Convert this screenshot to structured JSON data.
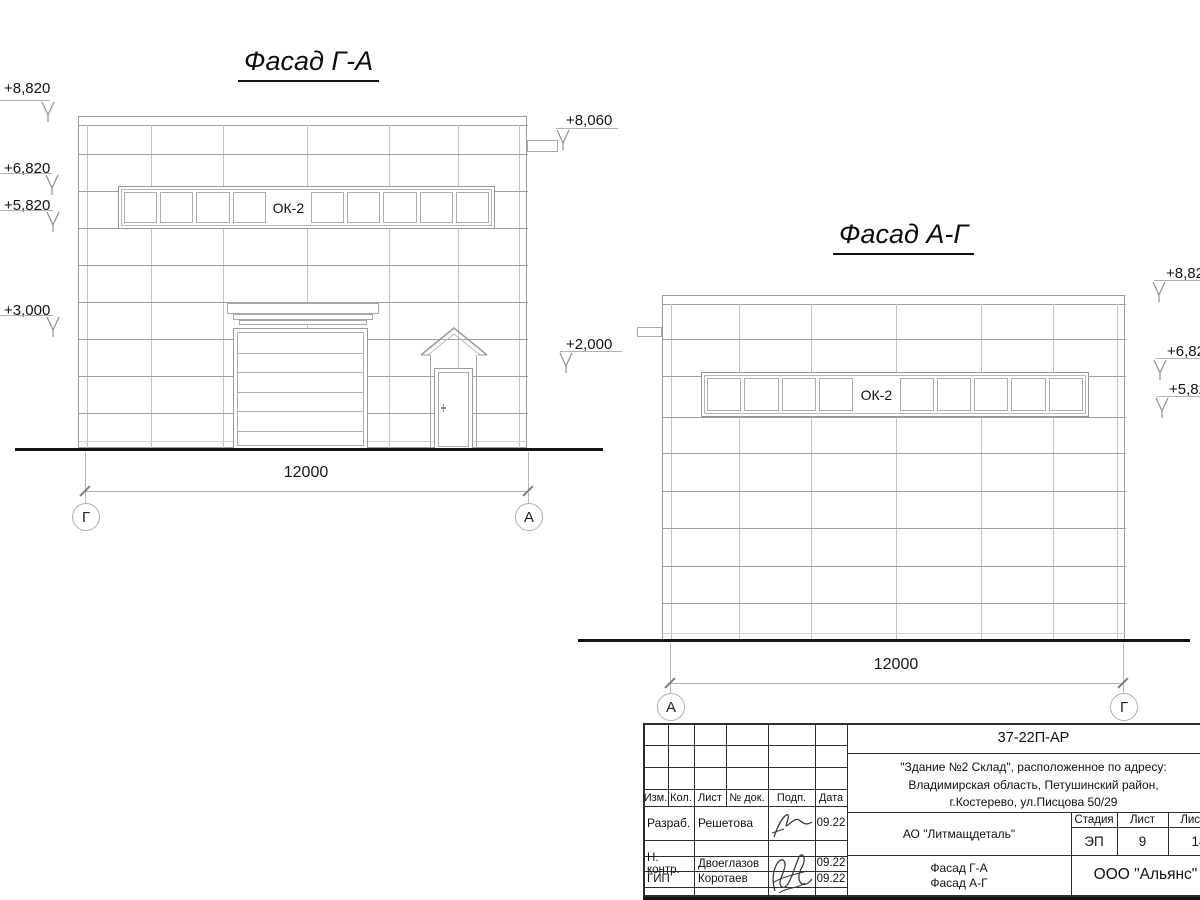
{
  "facade_ga": {
    "title": "Фасад Г-А",
    "window_label": "ОК-2",
    "dimension": "12000",
    "axis_left": "Г",
    "axis_right": "А",
    "elev_8820": "+8,820",
    "elev_6820": "+6,820",
    "elev_5820": "+5,820",
    "elev_3000": "+3,000",
    "elev_8060": "+8,060",
    "elev_2000": "+2,000"
  },
  "facade_ag": {
    "title": "Фасад А-Г",
    "window_label": "ОК-2",
    "dimension": "12000",
    "axis_left": "А",
    "axis_right": "Г",
    "elev_882": "+8,82",
    "elev_682": "+6,82",
    "elev_582": "+5,82"
  },
  "titleblock": {
    "doc_number": "37-22П-АР",
    "project_line1": "\"Здание №2 Склад\", расположенное по адресу:",
    "project_line2": "Владимирская область, Петушинский район,",
    "project_line3": "г.Костерево, ул.Писцова 50/29",
    "col_izm": "Изм.",
    "col_kol": "Кол.",
    "col_list": "Лист",
    "col_doc": "№ док.",
    "col_podp": "Подп.",
    "col_data": "Дата",
    "row1_role": "Разраб.",
    "row1_name": "Решетова",
    "row1_date": "09.22",
    "row2_role": "Н. контр.",
    "row2_name": "Двоеглазов",
    "row2_date": "09.22",
    "row3_role": "ГИП",
    "row3_name": "Коротаев",
    "row3_date": "09.22",
    "customer": "АО \"Литмащдеталь\"",
    "stage_header": "Стадия",
    "sheet_header": "Лист",
    "total_header": "Листов",
    "stage_value": "ЭП",
    "sheet_value": "9",
    "total_value": "14",
    "sheet_title_line1": "Фасад Г-А",
    "sheet_title_line2": "Фасад А-Г",
    "organization": "ООО \"Альянс\""
  }
}
